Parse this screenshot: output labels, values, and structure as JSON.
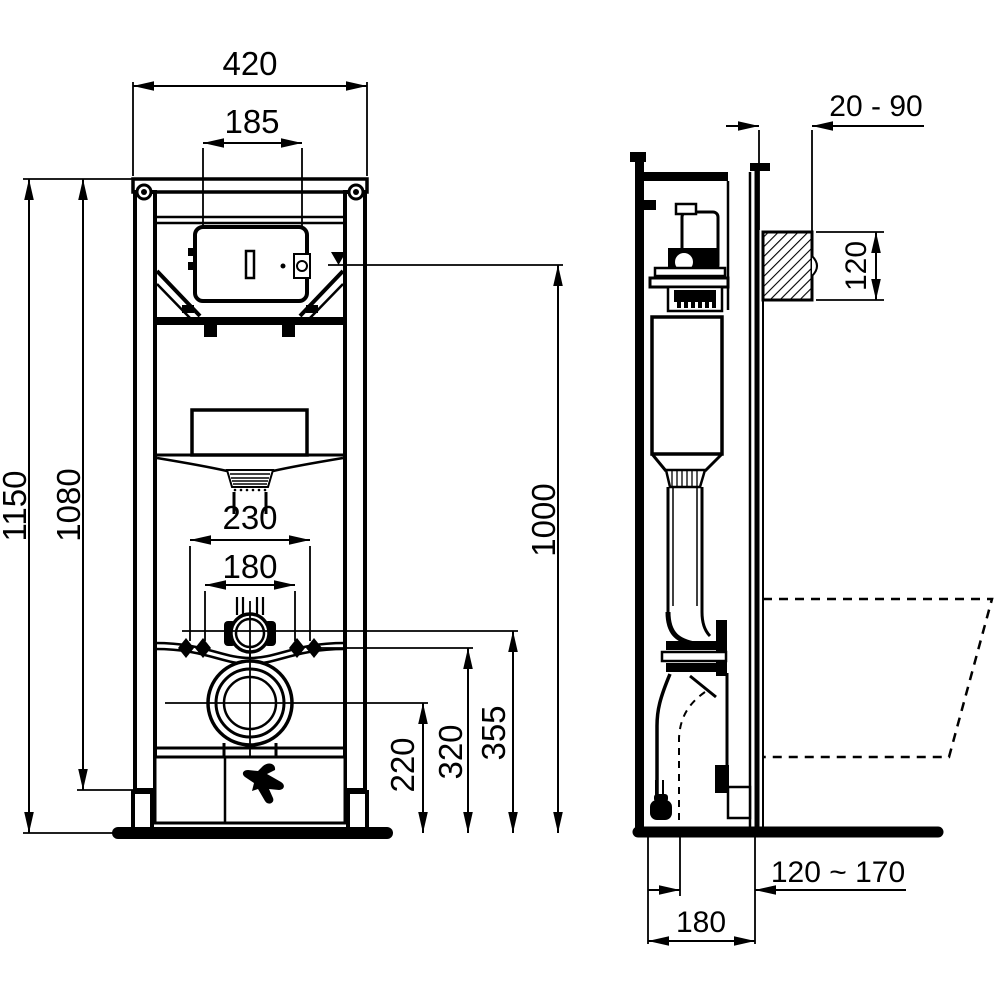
{
  "front": {
    "dim_overall_width": "420",
    "dim_plate_opening_width": "185",
    "dim_total_height": "1150",
    "dim_frame_height": "1080",
    "dim_fixing_outer": "230",
    "dim_fixing_inner": "180",
    "dim_outlet_center_height": "220",
    "dim_fixing_height": "320",
    "dim_bend_center_height": "355",
    "dim_water_level_height": "1000"
  },
  "side": {
    "dim_wall_finish_range": "20 - 90",
    "dim_shaft_height": "120",
    "dim_outlet_depth_range": "120 ~ 170",
    "dim_frame_depth": "180"
  },
  "colors": {
    "line": "#000000",
    "background": "#ffffff"
  }
}
